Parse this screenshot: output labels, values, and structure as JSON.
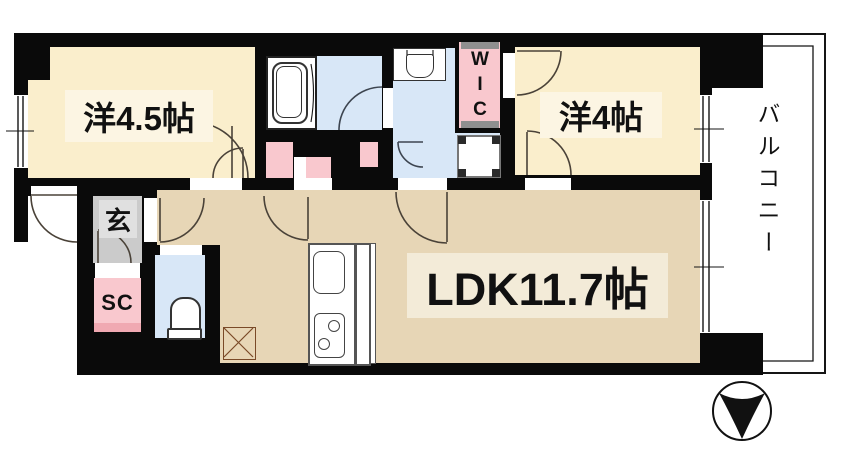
{
  "floor_plan": {
    "title": "apartment-floor-plan-1LDK-plus",
    "rooms": {
      "western45": {
        "label": "洋4.5帖",
        "type": "western-style room",
        "size_jo": 4.5
      },
      "western4": {
        "label": "洋4帖",
        "type": "western-style room",
        "size_jo": 4
      },
      "ldk": {
        "label": "LDK11.7帖",
        "type": "living-dining-kitchen",
        "size_jo": 11.7
      },
      "entrance": {
        "label": "玄",
        "type": "entrance (genkan)"
      },
      "shoe_closet": {
        "label": "SC",
        "type": "shoe closet"
      },
      "wic": {
        "label": "WIC",
        "type": "walk-in closet"
      },
      "balcony": {
        "label": "バルコニー",
        "type": "balcony"
      }
    },
    "fixtures": [
      "bathtub-icon",
      "washbasin-icon",
      "toilet-icon",
      "washing-machine-pan-icon",
      "kitchen-sink-icon",
      "two-burner-stove-icon",
      "refrigerator-space-icon",
      "compass-north-arrow-icon"
    ],
    "compass": {
      "arrow_direction": "down"
    },
    "colors": {
      "wall": "#0a0a0a",
      "room_cream": "#FAEECC",
      "room_tan": "#E7D6B6",
      "wet_area_blue": "#D8E7F7",
      "closet_pink": "#F9C8CE",
      "closet_pink_dark": "#F0A9B2",
      "entrance_gray": "#CBCBCB",
      "label_patch_cream": "#FCF5E3",
      "label_patch_tan": "#F3EBD8",
      "door_arc": "#4a4238"
    }
  }
}
